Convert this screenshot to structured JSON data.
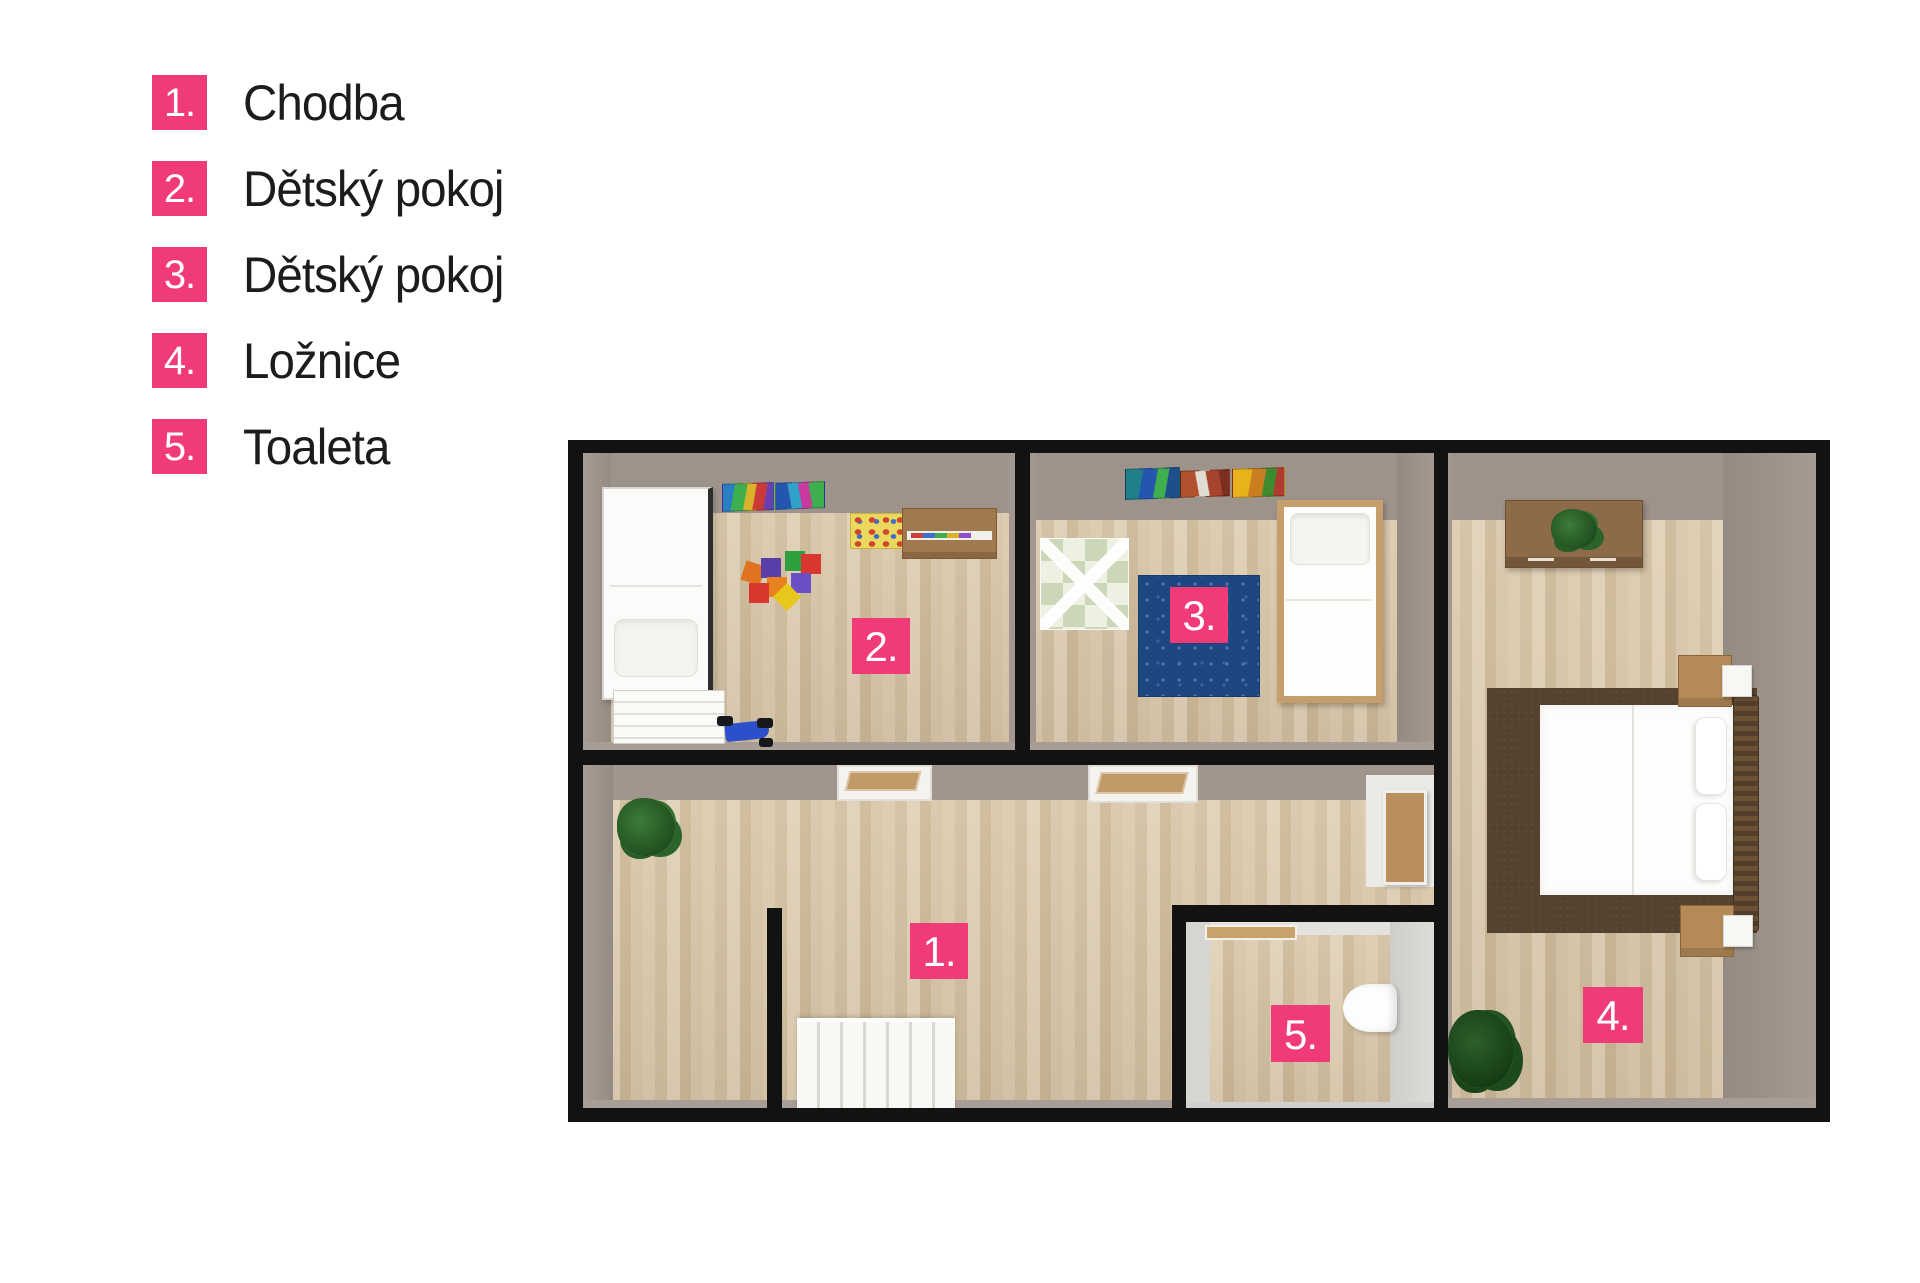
{
  "legend": {
    "items": [
      {
        "number": "1.",
        "label": "Chodba"
      },
      {
        "number": "2.",
        "label": "Dětský pokoj"
      },
      {
        "number": "3.",
        "label": "Dětský pokoj"
      },
      {
        "number": "4.",
        "label": "Ložnice"
      },
      {
        "number": "5.",
        "label": "Toaleta"
      }
    ]
  },
  "plan": {
    "markers": [
      {
        "number": "1."
      },
      {
        "number": "2."
      },
      {
        "number": "3."
      },
      {
        "number": "4."
      },
      {
        "number": "5."
      }
    ]
  },
  "colors": {
    "accent_pink": "#f13a78",
    "wall_black": "#121212",
    "floor_wood": "#d8c5a8",
    "wall_gray": "#9d938b",
    "rug_blue": "#1d4781",
    "bed_rug_brown": "#54412e"
  }
}
